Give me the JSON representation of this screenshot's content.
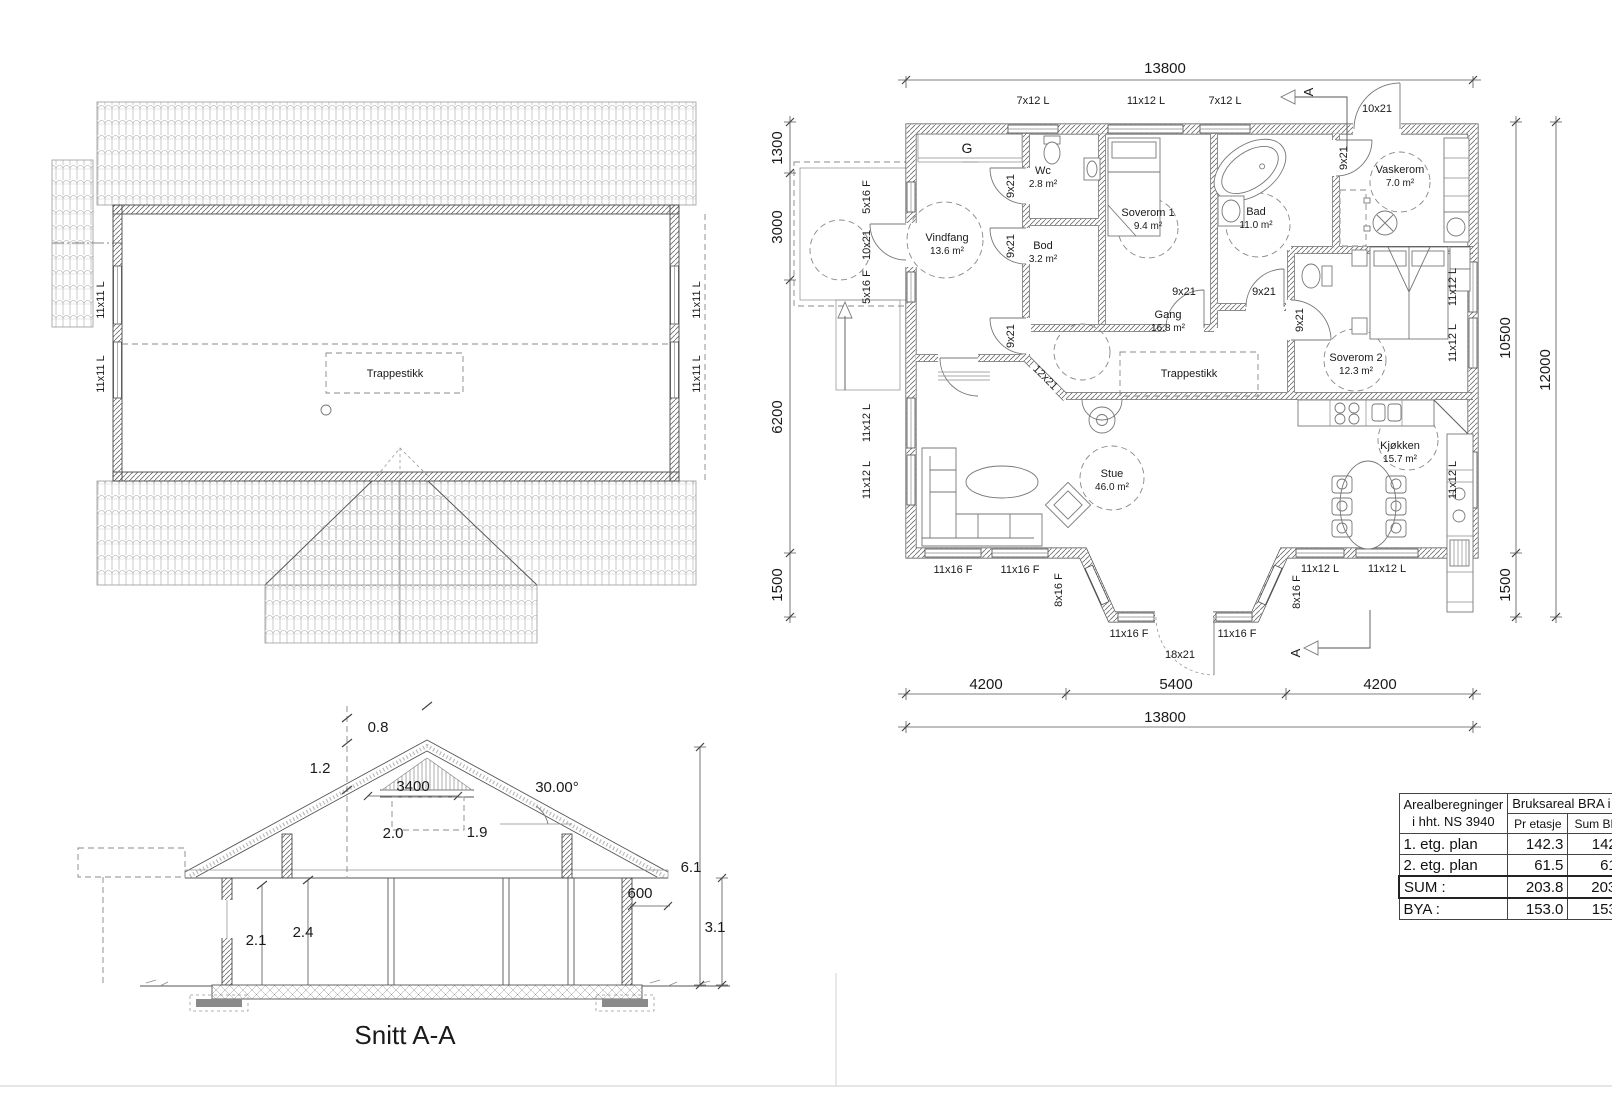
{
  "drawing": {
    "type": "architectural-plan",
    "sheets": [
      "roof-plan",
      "first-floor-plan",
      "section"
    ],
    "section_title": "Snitt A-A"
  },
  "area_table": {
    "col1_header_line1": "Arealberegninger",
    "col1_header_line2": "i hht. NS 3940",
    "bra_header": "Bruksareal BRA i m²",
    "sub_col1": "Pr etasje",
    "sub_col2": "Sum BRA",
    "rows": [
      {
        "label": "1. etg. plan",
        "pr_etasje": "142.3",
        "sum_bra": "142.3"
      },
      {
        "label": "2. etg. plan",
        "pr_etasje": "61.5",
        "sum_bra": "61.5"
      },
      {
        "label": "SUM :",
        "pr_etasje": "203.8",
        "sum_bra": "203.8"
      },
      {
        "label": "BYA :",
        "pr_etasje": "153.0",
        "sum_bra": "153.0"
      }
    ]
  },
  "rooms": [
    {
      "name": "Vindfang",
      "area": "13.6 m²"
    },
    {
      "name": "Wc",
      "area": "2.8 m²"
    },
    {
      "name": "Bod",
      "area": "3.2 m²"
    },
    {
      "name": "Soverom 1",
      "area": "9.4 m²"
    },
    {
      "name": "Bad",
      "area": "11.0 m²"
    },
    {
      "name": "Vaskerom",
      "area": "7.0 m²"
    },
    {
      "name": "Gang",
      "area": "16.8 m²"
    },
    {
      "name": "Soverom 2",
      "area": "12.3 m²"
    },
    {
      "name": "Stue",
      "area": "46.0 m²"
    },
    {
      "name": "Kjøkken",
      "area": "15.7 m²"
    }
  ],
  "floor_plan_labels": [
    {
      "name": "fp-dim-13800-top",
      "text": "13800",
      "x": 1165,
      "y": 73,
      "fs": 15
    },
    {
      "name": "fp-dim-1300",
      "text": "1300",
      "x": 782,
      "y": 148,
      "fs": 15,
      "rot": -90
    },
    {
      "name": "fp-dim-3000",
      "text": "3000",
      "x": 782,
      "y": 227,
      "fs": 15,
      "rot": -90
    },
    {
      "name": "fp-dim-6200",
      "text": "6200",
      "x": 782,
      "y": 417,
      "fs": 15,
      "rot": -90
    },
    {
      "name": "fp-dim-1500-left",
      "text": "1500",
      "x": 782,
      "y": 585,
      "fs": 15,
      "rot": -90
    },
    {
      "name": "fp-dim-10500",
      "text": "10500",
      "x": 1510,
      "y": 338,
      "fs": 15,
      "rot": -90
    },
    {
      "name": "fp-dim-12000",
      "text": "12000",
      "x": 1550,
      "y": 370,
      "fs": 15,
      "rot": -90
    },
    {
      "name": "fp-dim-1500-right",
      "text": "1500",
      "x": 1510,
      "y": 585,
      "fs": 15,
      "rot": -90
    },
    {
      "name": "fp-dim-4200-left",
      "text": "4200",
      "x": 986,
      "y": 689,
      "fs": 15
    },
    {
      "name": "fp-dim-5400",
      "text": "5400",
      "x": 1176,
      "y": 689,
      "fs": 15
    },
    {
      "name": "fp-dim-4200-right",
      "text": "4200",
      "x": 1380,
      "y": 689,
      "fs": 15
    },
    {
      "name": "fp-dim-13800-bottom",
      "text": "13800",
      "x": 1165,
      "y": 722,
      "fs": 15
    },
    {
      "name": "fp-win-7x12-a",
      "text": "7x12 L",
      "x": 1033,
      "y": 104,
      "fs": 11
    },
    {
      "name": "fp-win-11x12-top",
      "text": "11x12 L",
      "x": 1146,
      "y": 104,
      "fs": 11
    },
    {
      "name": "fp-win-7x12-b",
      "text": "7x12 L",
      "x": 1225,
      "y": 104,
      "fs": 11
    },
    {
      "name": "fp-door-10x21-top",
      "text": "10x21",
      "x": 1377,
      "y": 112,
      "fs": 11
    },
    {
      "name": "fp-win-5x16-a",
      "text": "5x16 F",
      "x": 870,
      "y": 197,
      "fs": 11,
      "rot": -90
    },
    {
      "name": "fp-door-10x21-left",
      "text": "10x21",
      "x": 870,
      "y": 245,
      "fs": 11,
      "rot": -90
    },
    {
      "name": "fp-win-5x16-b",
      "text": "5x16 F",
      "x": 870,
      "y": 287,
      "fs": 11,
      "rot": -90
    },
    {
      "name": "fp-win-11x12-la",
      "text": "11x12 L",
      "x": 870,
      "y": 423,
      "fs": 11,
      "rot": -90
    },
    {
      "name": "fp-win-11x12-lb",
      "text": "11x12 L",
      "x": 870,
      "y": 480,
      "fs": 11,
      "rot": -90
    },
    {
      "name": "fp-win-11x12-ra",
      "text": "11x12 L",
      "x": 1456,
      "y": 287,
      "fs": 11,
      "rot": -90
    },
    {
      "name": "fp-win-11x12-rb",
      "text": "11x12 L",
      "x": 1456,
      "y": 343,
      "fs": 11,
      "rot": -90
    },
    {
      "name": "fp-win-11x12-rc",
      "text": "11x12 L",
      "x": 1456,
      "y": 480,
      "fs": 11,
      "rot": -90
    },
    {
      "name": "fp-win-11x16-a",
      "text": "11x16 F",
      "x": 953,
      "y": 573,
      "fs": 11
    },
    {
      "name": "fp-win-11x16-b",
      "text": "11x16 F",
      "x": 1020,
      "y": 573,
      "fs": 11
    },
    {
      "name": "fp-win-8x16-l",
      "text": "8x16 F",
      "x": 1062,
      "y": 590,
      "fs": 11,
      "rot": -90
    },
    {
      "name": "fp-win-11x16-c",
      "text": "11x16 F",
      "x": 1129,
      "y": 637,
      "fs": 11
    },
    {
      "name": "fp-door-18x21",
      "text": "18x21",
      "x": 1180,
      "y": 658,
      "fs": 11
    },
    {
      "name": "fp-win-11x16-d",
      "text": "11x16 F",
      "x": 1237,
      "y": 637,
      "fs": 11
    },
    {
      "name": "fp-win-8x16-r",
      "text": "8x16 F",
      "x": 1300,
      "y": 592,
      "fs": 11,
      "rot": -90
    },
    {
      "name": "fp-win-11x12-ba",
      "text": "11x12 L",
      "x": 1320,
      "y": 572,
      "fs": 11
    },
    {
      "name": "fp-win-11x12-bb",
      "text": "11x12 L",
      "x": 1387,
      "y": 572,
      "fs": 11
    },
    {
      "name": "fp-door-9x21-a",
      "text": "9x21",
      "x": 1014,
      "y": 186,
      "fs": 11,
      "rot": -90
    },
    {
      "name": "fp-door-9x21-b",
      "text": "9x21",
      "x": 1014,
      "y": 246,
      "fs": 11,
      "rot": -90
    },
    {
      "name": "fp-door-9x21-c",
      "text": "9x21",
      "x": 1014,
      "y": 336,
      "fs": 11,
      "rot": -90
    },
    {
      "name": "fp-door-9x21-d",
      "text": "9x21",
      "x": 1347,
      "y": 158,
      "fs": 11,
      "rot": -90
    },
    {
      "name": "fp-door-9x21-e",
      "text": "9x21",
      "x": 1303,
      "y": 320,
      "fs": 11,
      "rot": -90
    },
    {
      "name": "fp-door-9x21-f",
      "text": "9x21",
      "x": 1184,
      "y": 295,
      "fs": 11
    },
    {
      "name": "fp-door-9x21-g",
      "text": "9x21",
      "x": 1264,
      "y": 295,
      "fs": 11
    },
    {
      "name": "fp-door-12x21",
      "text": "12x21",
      "x": 1043,
      "y": 380,
      "fs": 11,
      "rot": 45
    },
    {
      "name": "fp-label-g",
      "text": "G",
      "x": 967,
      "y": 153,
      "fs": 14
    },
    {
      "name": "fp-room-wc",
      "text": "Wc",
      "x": 1043,
      "y": 174,
      "fs": 11
    },
    {
      "name": "fp-area-wc",
      "text": "2.8 m²",
      "x": 1043,
      "y": 187,
      "fs": 10
    },
    {
      "name": "fp-room-vindfang",
      "text": "Vindfang",
      "x": 947,
      "y": 241,
      "fs": 11
    },
    {
      "name": "fp-area-vindfang",
      "text": "13.6 m²",
      "x": 947,
      "y": 254,
      "fs": 10
    },
    {
      "name": "fp-room-bod",
      "text": "Bod",
      "x": 1043,
      "y": 249,
      "fs": 11
    },
    {
      "name": "fp-area-bod",
      "text": "3.2 m²",
      "x": 1043,
      "y": 262,
      "fs": 10
    },
    {
      "name": "fp-room-soverom1",
      "text": "Soverom 1",
      "x": 1148,
      "y": 216,
      "fs": 11
    },
    {
      "name": "fp-area-soverom1",
      "text": "9.4 m²",
      "x": 1148,
      "y": 229,
      "fs": 10
    },
    {
      "name": "fp-room-bad",
      "text": "Bad",
      "x": 1256,
      "y": 215,
      "fs": 11
    },
    {
      "name": "fp-area-bad",
      "text": "11.0 m²",
      "x": 1256,
      "y": 228,
      "fs": 10
    },
    {
      "name": "fp-room-vaskerom",
      "text": "Vaskerom",
      "x": 1400,
      "y": 173,
      "fs": 11
    },
    {
      "name": "fp-area-vaskerom",
      "text": "7.0 m²",
      "x": 1400,
      "y": 186,
      "fs": 10
    },
    {
      "name": "fp-room-gang",
      "text": "Gang",
      "x": 1168,
      "y": 318,
      "fs": 11
    },
    {
      "name": "fp-area-gang",
      "text": "16.8 m²",
      "x": 1168,
      "y": 331,
      "fs": 10
    },
    {
      "name": "fp-label-trappestikk",
      "text": "Trappestikk",
      "x": 1189,
      "y": 377,
      "fs": 11
    },
    {
      "name": "fp-room-soverom2",
      "text": "Soverom 2",
      "x": 1356,
      "y": 361,
      "fs": 11
    },
    {
      "name": "fp-area-soverom2",
      "text": "12.3 m²",
      "x": 1356,
      "y": 374,
      "fs": 10
    },
    {
      "name": "fp-room-stue",
      "text": "Stue",
      "x": 1112,
      "y": 477,
      "fs": 11
    },
    {
      "name": "fp-area-stue",
      "text": "46.0 m²",
      "x": 1112,
      "y": 490,
      "fs": 10
    },
    {
      "name": "fp-room-kjokken",
      "text": "Kjøkken",
      "x": 1400,
      "y": 449,
      "fs": 11
    },
    {
      "name": "fp-area-kjokken",
      "text": "15.7 m²",
      "x": 1400,
      "y": 462,
      "fs": 10
    },
    {
      "name": "fp-section-a-top",
      "text": "A",
      "x": 1313,
      "y": 92,
      "fs": 13,
      "rot": -90
    },
    {
      "name": "fp-section-a-bottom",
      "text": "A",
      "x": 1300,
      "y": 653,
      "fs": 13,
      "rot": -90
    }
  ],
  "roof_plan_labels": [
    {
      "name": "rp-label-trappestikk",
      "text": "Trappestikk",
      "x": 395,
      "y": 377,
      "fs": 11
    },
    {
      "name": "rp-win-11x11-la",
      "text": "11x11 L",
      "x": 104,
      "y": 300,
      "fs": 11,
      "rot": -90
    },
    {
      "name": "rp-win-11x11-lb",
      "text": "11x11 L",
      "x": 104,
      "y": 374,
      "fs": 11,
      "rot": -90
    },
    {
      "name": "rp-win-11x11-ra",
      "text": "11x11 L",
      "x": 700,
      "y": 300,
      "fs": 11,
      "rot": -90
    },
    {
      "name": "rp-win-11x11-rb",
      "text": "11x11 L",
      "x": 700,
      "y": 374,
      "fs": 11,
      "rot": -90
    }
  ],
  "section_labels": [
    {
      "name": "sc-dim-0-8",
      "text": "0.8",
      "x": 378,
      "y": 732,
      "fs": 15
    },
    {
      "name": "sc-dim-1-2",
      "text": "1.2",
      "x": 320,
      "y": 773,
      "fs": 15
    },
    {
      "name": "sc-dim-3400",
      "text": "3400",
      "x": 413,
      "y": 791,
      "fs": 15
    },
    {
      "name": "sc-angle",
      "text": "30.00°",
      "x": 557,
      "y": 792,
      "fs": 15
    },
    {
      "name": "sc-dim-2-0",
      "text": "2.0",
      "x": 393,
      "y": 838,
      "fs": 15
    },
    {
      "name": "sc-dim-1-9",
      "text": "1.9",
      "x": 477,
      "y": 837,
      "fs": 15
    },
    {
      "name": "sc-dim-6-1",
      "text": "6.1",
      "x": 691,
      "y": 872,
      "fs": 15
    },
    {
      "name": "sc-dim-600",
      "text": "600",
      "x": 640,
      "y": 898,
      "fs": 15
    },
    {
      "name": "sc-dim-3-1",
      "text": "3.1",
      "x": 715,
      "y": 932,
      "fs": 15
    },
    {
      "name": "sc-dim-2-1",
      "text": "2.1",
      "x": 256,
      "y": 945,
      "fs": 15
    },
    {
      "name": "sc-dim-2-4",
      "text": "2.4",
      "x": 303,
      "y": 937,
      "fs": 15
    },
    {
      "name": "sc-title",
      "text": "Snitt A-A",
      "x": 405,
      "y": 1044,
      "fs": 26
    }
  ]
}
